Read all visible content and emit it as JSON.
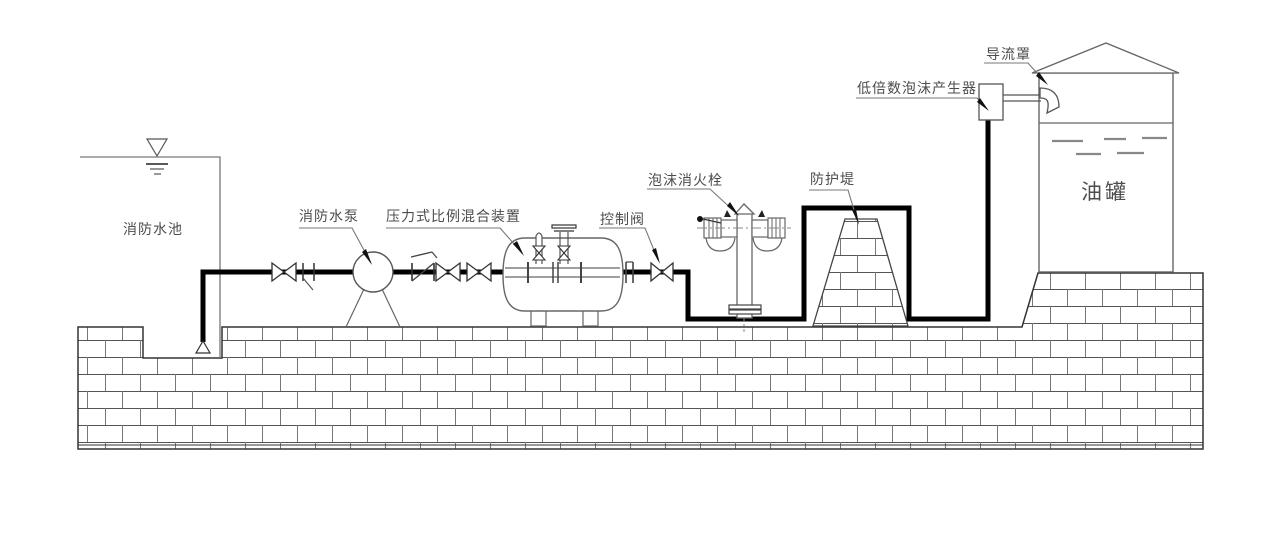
{
  "diagram_type": "foam-fire-extinguishing-system-schematic",
  "labels": {
    "pool": "消防水池",
    "pump": "消防水泵",
    "proportioner": "压力式比例混合装置",
    "control_valve": "控制阀",
    "foam_hydrant": "泡沫消火栓",
    "dike": "防护堤",
    "foam_generator": "低倍数泡沫产生器",
    "deflector": "导流罩",
    "oil_tank": "油罐"
  },
  "colors": {
    "pipe": "#000000",
    "thin_line": "#666666",
    "label_text": "#4d4d4d",
    "brick_joint": "#555555",
    "background": "#ffffff"
  },
  "components": [
    "fire-water-pool",
    "foot-valve",
    "gate-valves",
    "fire-pump",
    "check-valve",
    "pressure-proportioner-tank",
    "control-valve",
    "foam-hydrant",
    "protective-dike",
    "low-expansion-foam-generator",
    "deflector",
    "oil-tank"
  ]
}
